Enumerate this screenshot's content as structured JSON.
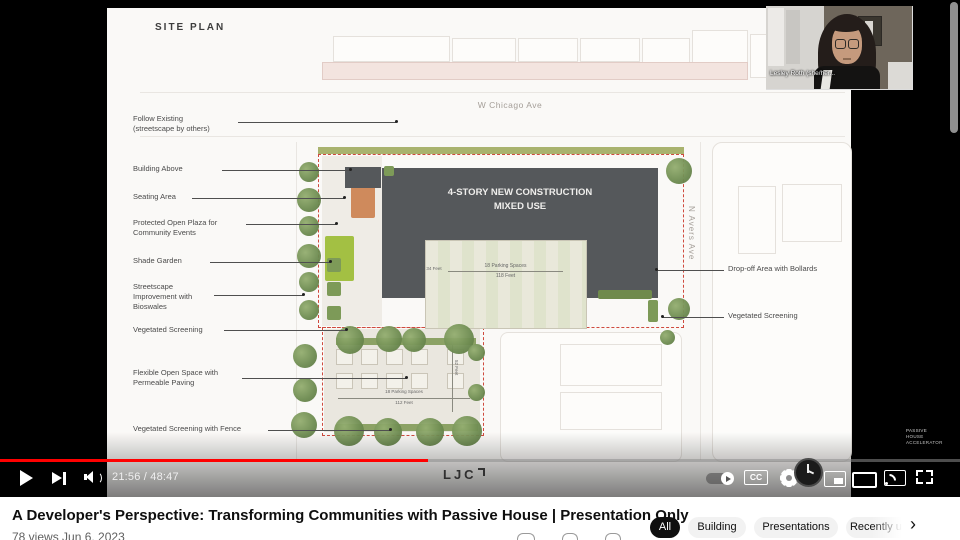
{
  "player": {
    "time": "21:56 / 48:47",
    "progress_fraction": 0.45,
    "cc_label": "CC",
    "watermark": "PASSIVE\nHOUSE\nACCELERATOR"
  },
  "webcam": {
    "name_tag": "Lesley Roth (she/her..."
  },
  "slide": {
    "title": "SITE PLAN",
    "street_h": "W Chicago Ave",
    "street_v": "N Avers Ave",
    "building_label": "4-STORY NEW CONSTRUCTION\nMIXED USE",
    "logo_text": "LJC",
    "left_labels": [
      "Follow Existing\n(streetscape by others)",
      "Building Above",
      "Seating Area",
      "Protected Open Plaza for\nCommunity Events",
      "Shade Garden",
      "Streetscape\nImprovement with\nBioswales",
      "Vegetated Screening",
      "Flexible Open Space with\nPermeable Paving",
      "Vegetated Screening with Fence"
    ],
    "right_labels": [
      "Drop-off Area with Bollards",
      "Vegetated Screening"
    ],
    "dims": {
      "upper_spaces": "18 Parking Spaces",
      "upper_length": "118 Feet",
      "upper_depth": "34 Feet",
      "lower_spaces": "18 Parking Spaces",
      "lower_length": "112 Feet",
      "lower_depth": "52 Feet"
    }
  },
  "page": {
    "video_title": "A Developer's Perspective: Transforming Communities with Passive House | Presentation Only",
    "meta": "78 views  Jun 6, 2023",
    "chips": [
      "All",
      "Building",
      "Presentations",
      "Recently up"
    ],
    "chips_more": "›"
  }
}
